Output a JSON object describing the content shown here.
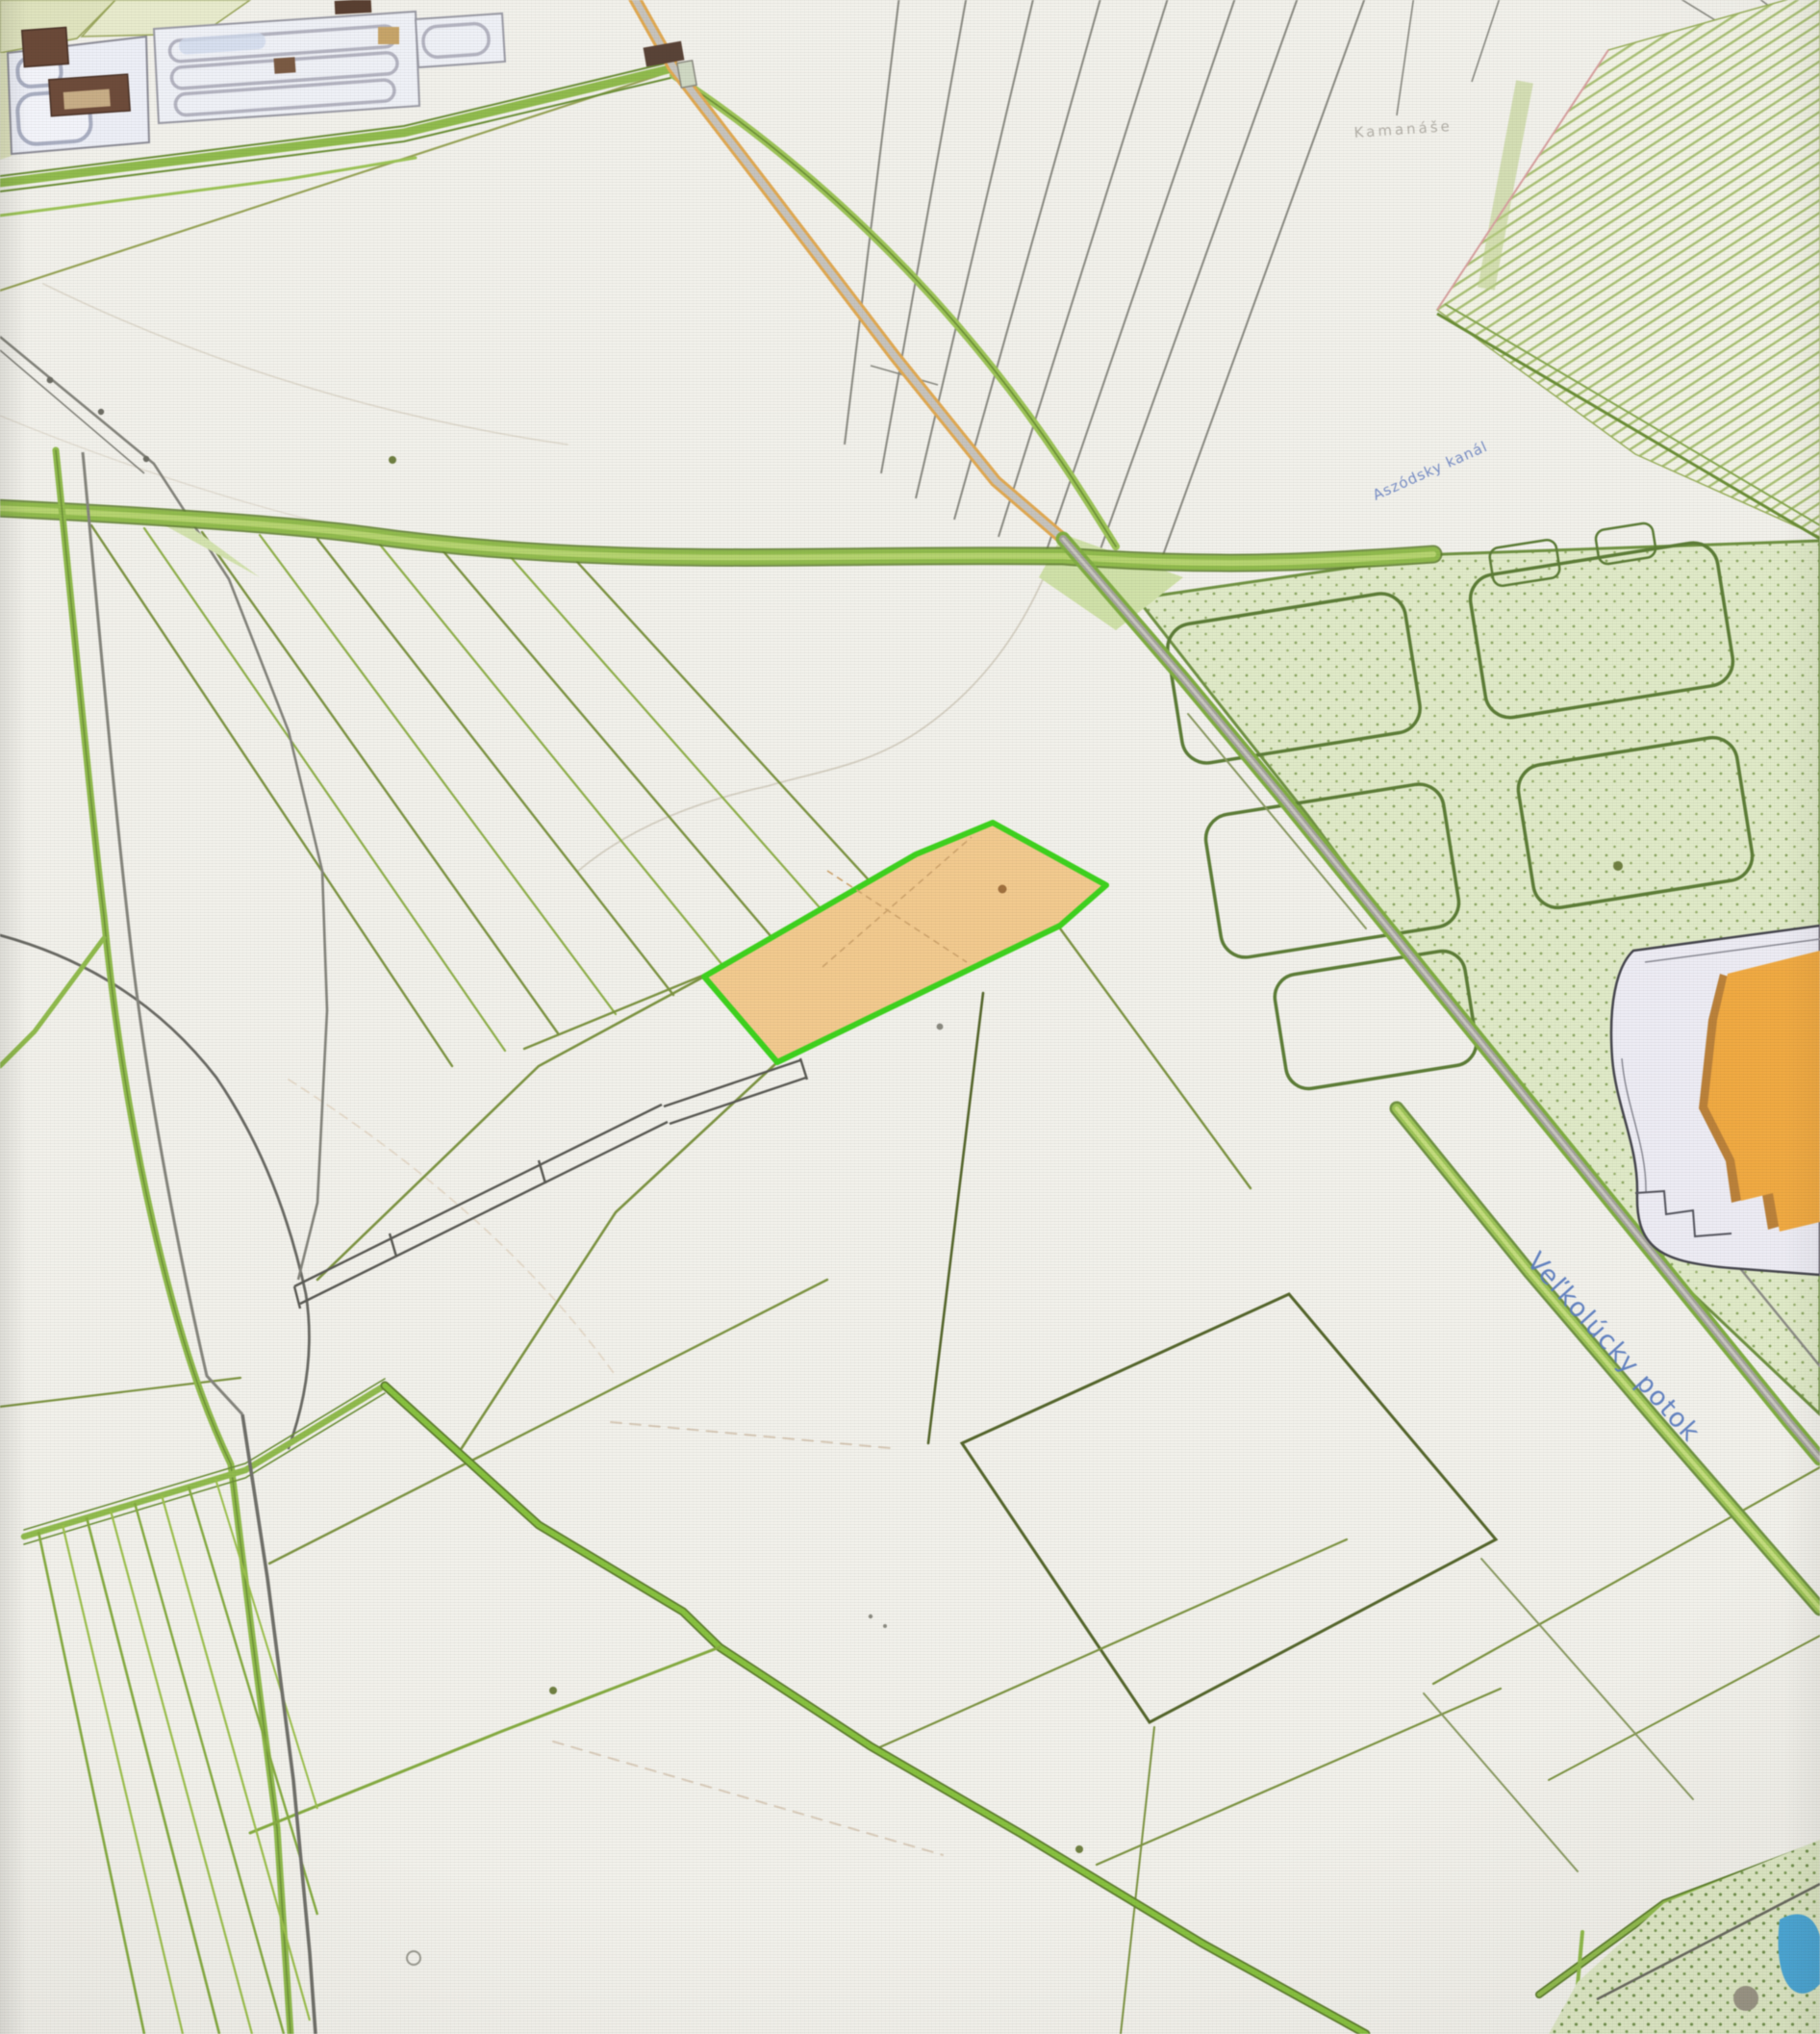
{
  "window": {
    "type": "cadastral-map-photo"
  },
  "map": {
    "labels": {
      "stream": "Veľkolúcky potok",
      "canal": "Aszódsky kanál",
      "locality": "Kamanáše"
    },
    "selected_parcel": {
      "fill": "#f2c98c",
      "border": "#3bd31a",
      "status": "highlighted"
    },
    "colors": {
      "paper": "#f1f0ea",
      "parcel_line_olive": "#7d9440",
      "parcel_line_green": "#86b043",
      "road_gray": "#c6c3bd",
      "road_edge_orange": "#e2a94f",
      "field_road_green": "#8fbb4a",
      "orchard_fill": "#dfe9c6",
      "vineyard_row": "#a9c072",
      "water": "#49a8d8",
      "building_orange": "#f1a93f",
      "building_brown": "#6e4b39",
      "label_blue": "#5b7ec2",
      "label_gray": "#a8a49c"
    }
  }
}
